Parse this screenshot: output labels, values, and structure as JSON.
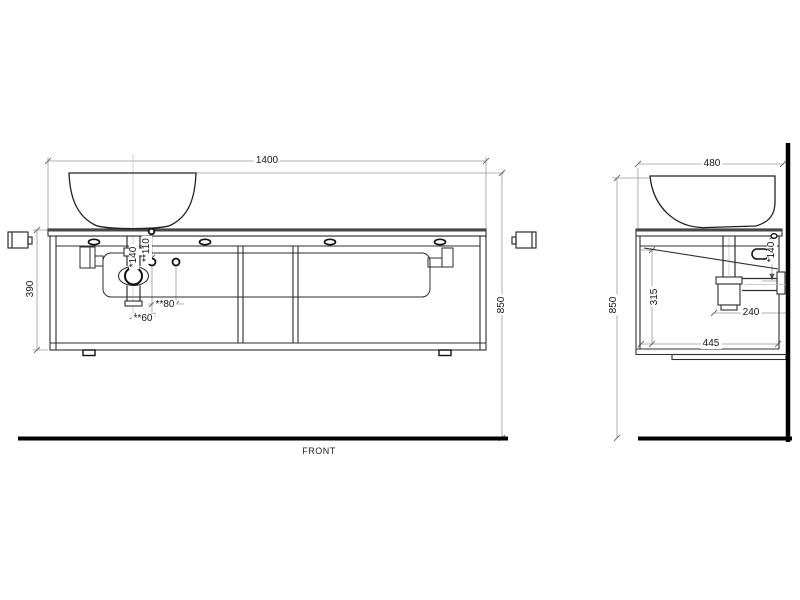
{
  "front_view": {
    "view_label": "FRONT",
    "dims": {
      "overall_width": "1400",
      "overall_height": "850",
      "cabinet_height": "390",
      "drain_drop": "*140",
      "faucet_hole_height": "**110",
      "hole_spacing": "**80",
      "hole_offset": "**60"
    }
  },
  "side_view": {
    "dims": {
      "overall_depth": "480",
      "overall_height": "850",
      "interior_height": "315",
      "outlet_distance": "240",
      "base_depth": "445",
      "drain_drop": "*140"
    }
  },
  "colors": {
    "background": "#ffffff",
    "line": "#2e2e2e",
    "heavy_line": "#000000",
    "dimension_line": "#9a9a9a"
  }
}
